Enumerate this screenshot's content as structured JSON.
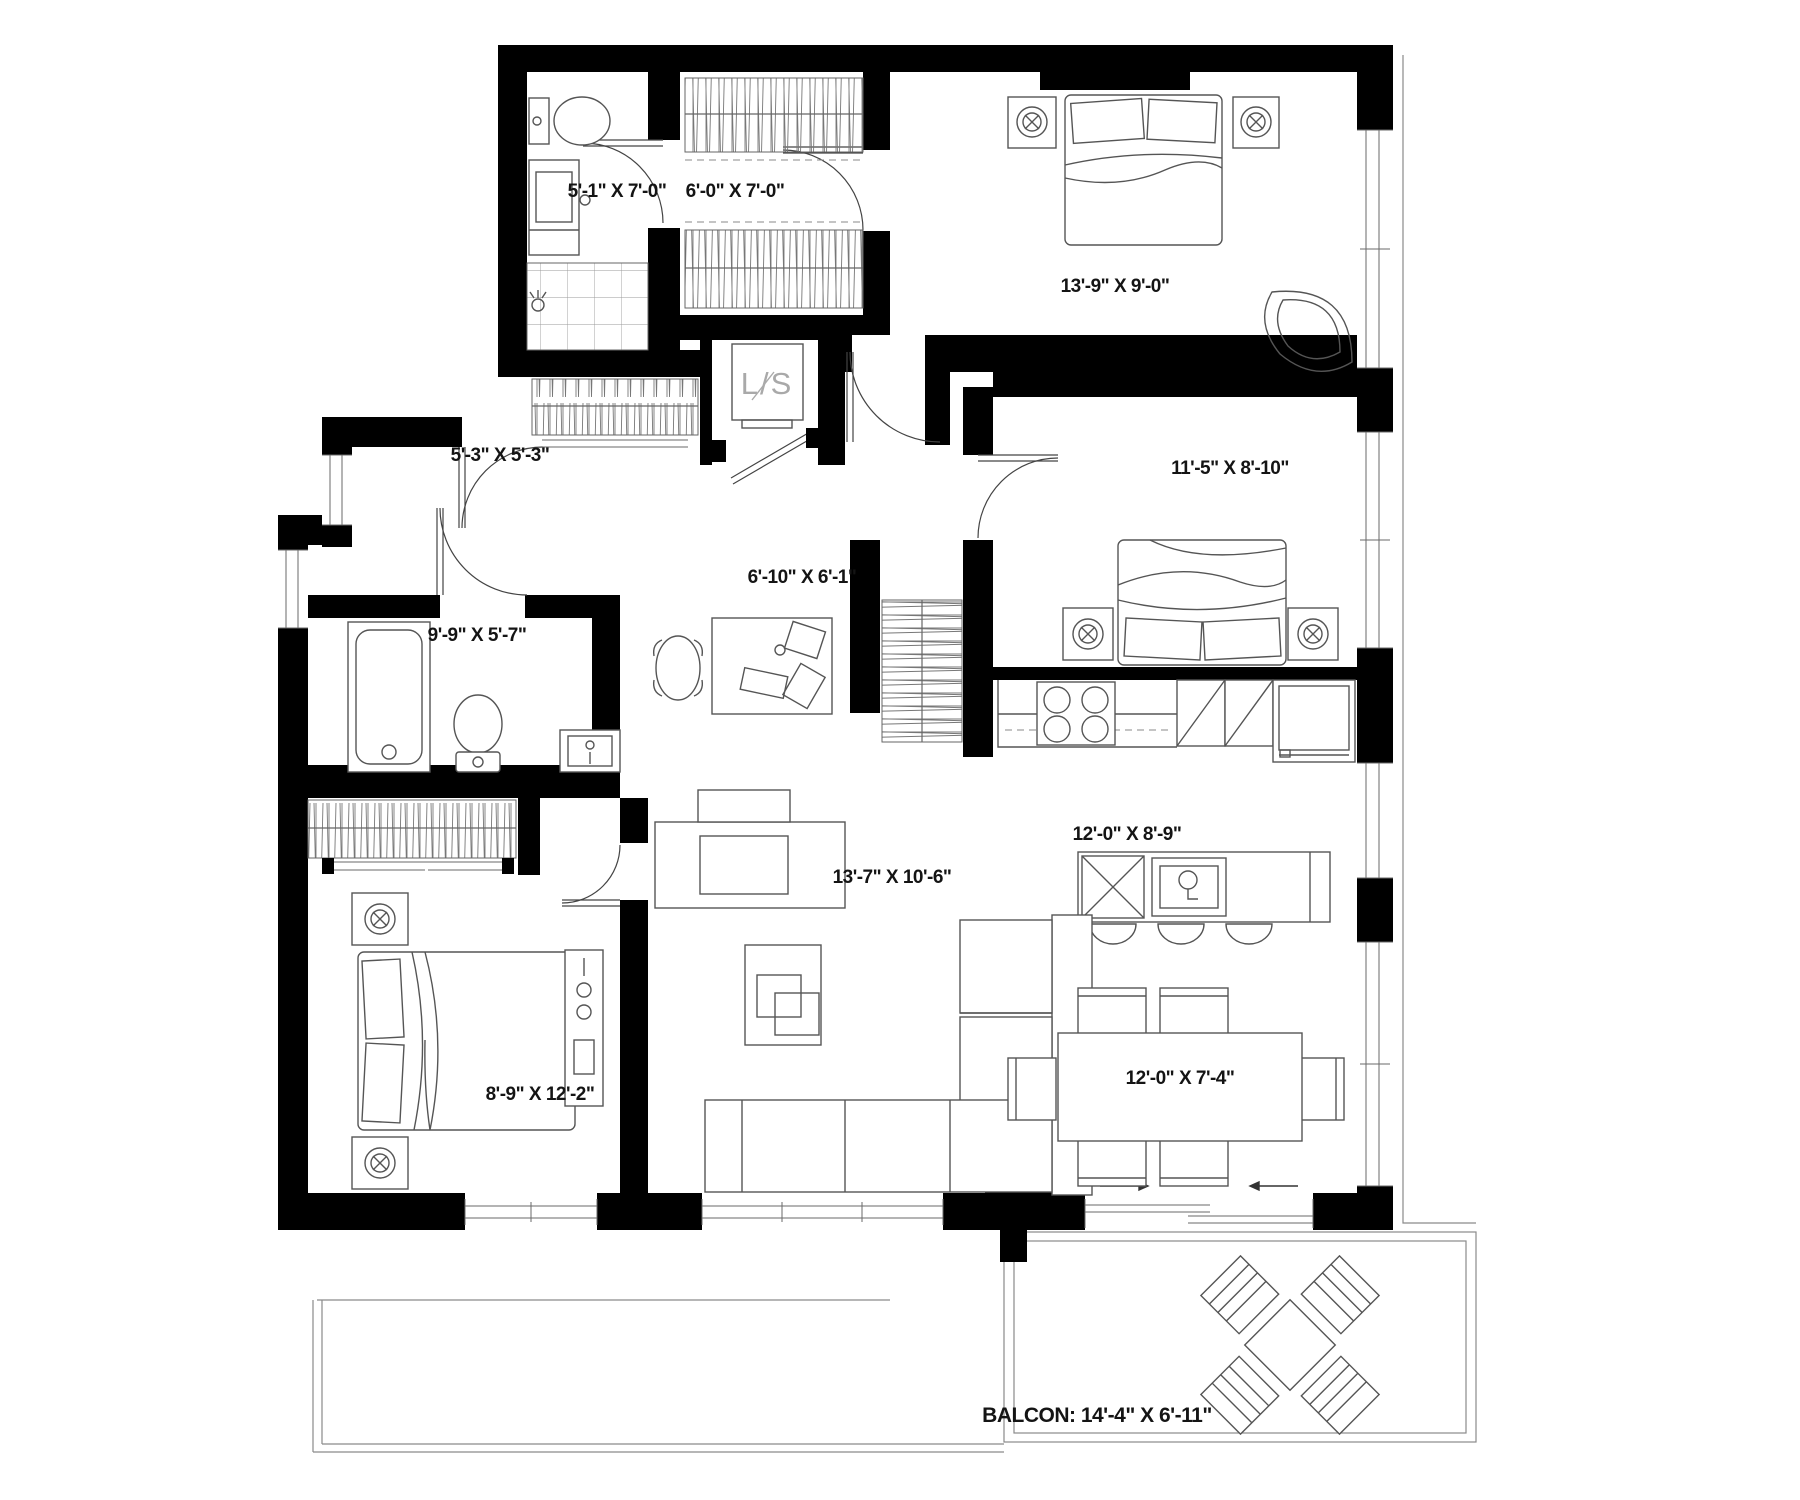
{
  "plan": {
    "type": "apartment-floor-plan",
    "background_color": "#ffffff",
    "wall_color": "#000000",
    "furniture_line_color": "#555555",
    "rooms": [
      {
        "id": "bathroom-top",
        "label": "5'-1\" X 7'-0\""
      },
      {
        "id": "closet-top",
        "label": "6'-0\" X 7'-0\""
      },
      {
        "id": "bedroom-top-right",
        "label": "13'-9\" X 9'-0\""
      },
      {
        "id": "entry",
        "label": "5'-3\" X 5'-3\""
      },
      {
        "id": "bedroom-right",
        "label": "11'-5\" X 8'-10\""
      },
      {
        "id": "den",
        "label": "6'-10\" X 6'-1\""
      },
      {
        "id": "bathroom-left",
        "label": "9'-9\" X 5'-7\""
      },
      {
        "id": "kitchen",
        "label": "12'-0\" X 8'-9\""
      },
      {
        "id": "living",
        "label": "13'-7\" X 10'-6\""
      },
      {
        "id": "bedroom-bottom-left",
        "label": "8'-9\" X 12'-2\""
      },
      {
        "id": "dining",
        "label": "12'-0\" X 7'-4\""
      },
      {
        "id": "balcony",
        "label": "BALCON: 14'-4\" X 6'-11\""
      }
    ],
    "laundry": {
      "label": "L/S"
    }
  }
}
